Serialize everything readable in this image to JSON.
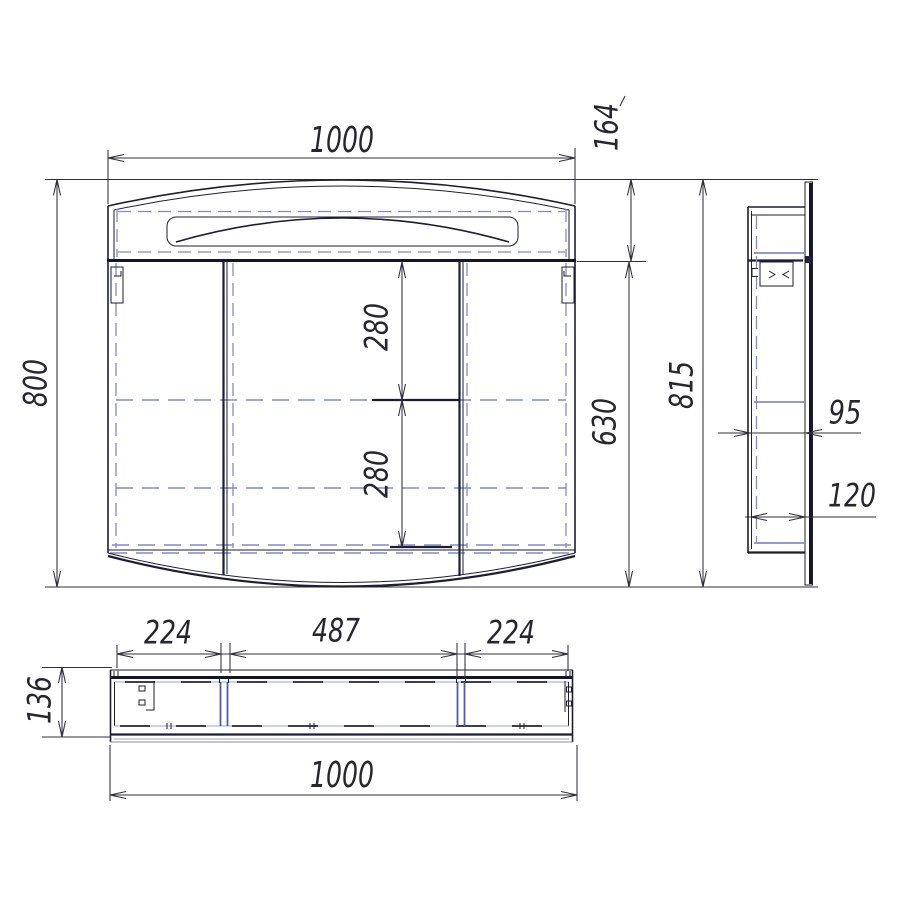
{
  "colors": {
    "main_line": "#1d1d33",
    "hidden_line": "#8289cb",
    "divider_line": "#5058b0",
    "dimension_line": "#2f2f3a",
    "text": "#26262e",
    "background": "#ffffff"
  },
  "dims": {
    "front": {
      "width": "1000",
      "height": "800",
      "top_section": "164",
      "body_height": "630",
      "shelf_upper": "280",
      "shelf_lower": "280"
    },
    "side": {
      "height": "815",
      "depth_body": "95",
      "depth_total": "120"
    },
    "top": {
      "segment_left": "224",
      "segment_center": "487",
      "segment_right": "224",
      "depth": "136",
      "width": "1000"
    }
  }
}
